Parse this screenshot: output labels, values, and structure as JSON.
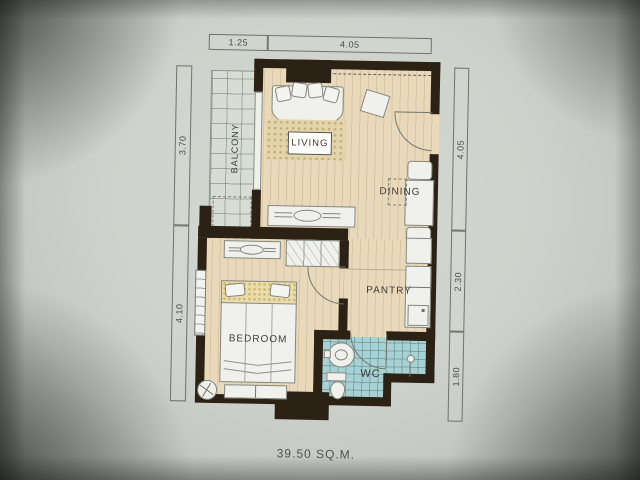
{
  "plan": {
    "area_label": "39.50 SQ.M.",
    "rooms": {
      "living": "LIVING",
      "dining": "DINING",
      "pantry": "PANTRY",
      "bedroom": "BEDROOM",
      "balcony": "BALCONY",
      "wc": "WC"
    },
    "dimensions": {
      "top": [
        "1.25",
        "4.05"
      ],
      "left": [
        "3.70",
        "4.10"
      ],
      "right": [
        "4.05",
        "2.30",
        "1.80"
      ]
    },
    "colors": {
      "wall": "#2b2115",
      "wood_floor": "#e9d9bb",
      "balcony_tile": "#d7ddd5",
      "wc_tile": "#a8d1d4",
      "paper": "#cdd3cc",
      "label_text": "#3c3d37"
    }
  }
}
